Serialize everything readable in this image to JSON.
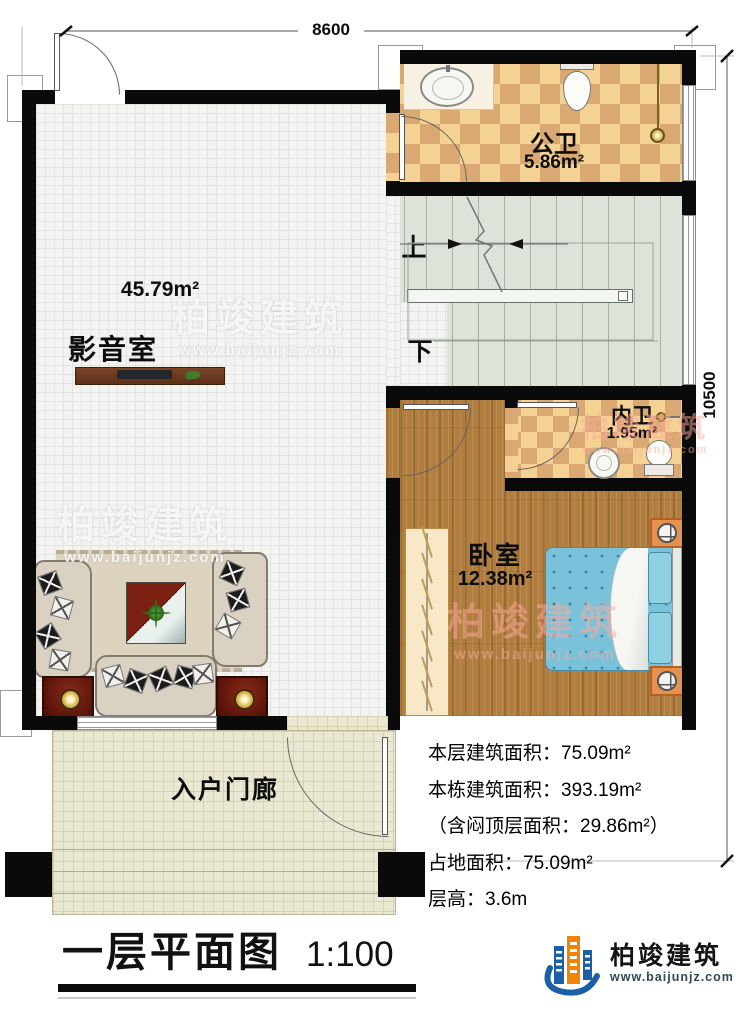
{
  "dimensions": {
    "width": "8600",
    "height": "10500"
  },
  "rooms": {
    "public_bath": {
      "name": "公卫",
      "area": "5.86m²"
    },
    "media_room": {
      "name": "影音室",
      "area": "45.79m²"
    },
    "inner_bath": {
      "name": "内卫",
      "area": "1.95m²"
    },
    "bedroom": {
      "name": "卧室",
      "area": "12.38m²"
    },
    "porch": {
      "name": "入户门廊"
    }
  },
  "stairs": {
    "up_label": "上",
    "down_label": "下"
  },
  "info": {
    "lines": [
      "本层建筑面积：75.09m²",
      "本栋建筑面积：393.19m²",
      "（含闷顶层面积：29.86m²）",
      "占地面积：75.09m²",
      "层高：3.6m"
    ]
  },
  "title": {
    "text": "一层平面图",
    "scale": "1:100"
  },
  "brand": {
    "name": "柏竣建筑",
    "website": "www.baijunjz.com"
  },
  "colors": {
    "wall": "#0a0a0a",
    "wood_floor": "#b17e40",
    "tile_light": "#f4d294",
    "tile_dark": "#d9a873",
    "stairs": "#dde3d9",
    "porch": "#ebe8d2",
    "bed": "#79c2d9",
    "brand_blue": "#1b5fa8",
    "brand_orange": "#f08300"
  }
}
